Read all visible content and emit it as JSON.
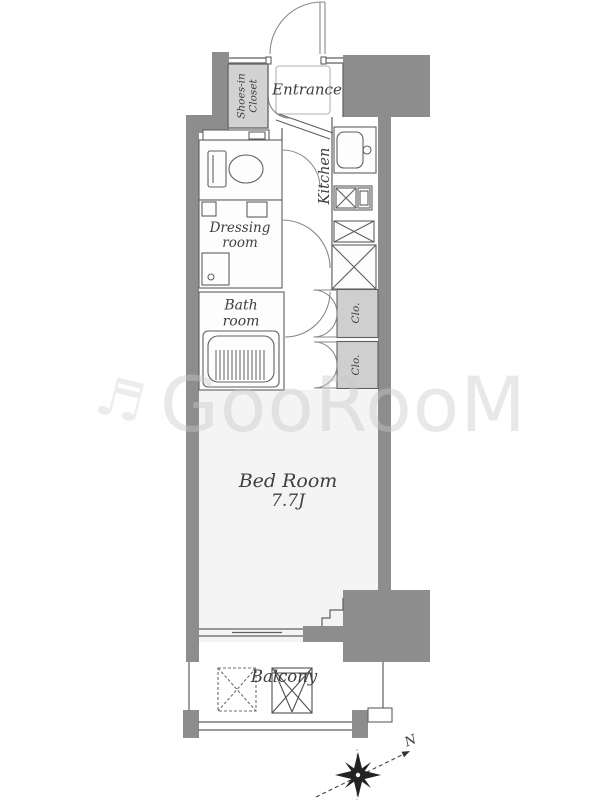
{
  "plan": {
    "rooms": {
      "shoes_in_closet": {
        "line1": "Shoes-in",
        "line2": "Closet"
      },
      "entrance": {
        "label": "Entrance"
      },
      "kitchen": {
        "label": "Kitchen"
      },
      "dressing_room": {
        "line1": "Dressing",
        "line2": "room"
      },
      "bath_room": {
        "line1": "Bath",
        "line2": "room"
      },
      "closet_upper": {
        "label": "Clo."
      },
      "closet_lower": {
        "label": "Clo."
      },
      "bed_room": {
        "label": "Bed Room",
        "size": "7.7J"
      },
      "balcony": {
        "label": "Balcony"
      }
    },
    "compass": {
      "north_label": "N"
    },
    "watermark": {
      "text": "GooRooM",
      "glyph": "♬"
    },
    "colors": {
      "wall": "#8d8d8d",
      "closet_fill": "#cfcfcf",
      "sic_fill": "#d2d2d2",
      "bedroom_fill": "#f4f4f4",
      "line": "#5f5f5f",
      "text": "#3f3f3f",
      "watermark": "#c9c9c9"
    }
  }
}
